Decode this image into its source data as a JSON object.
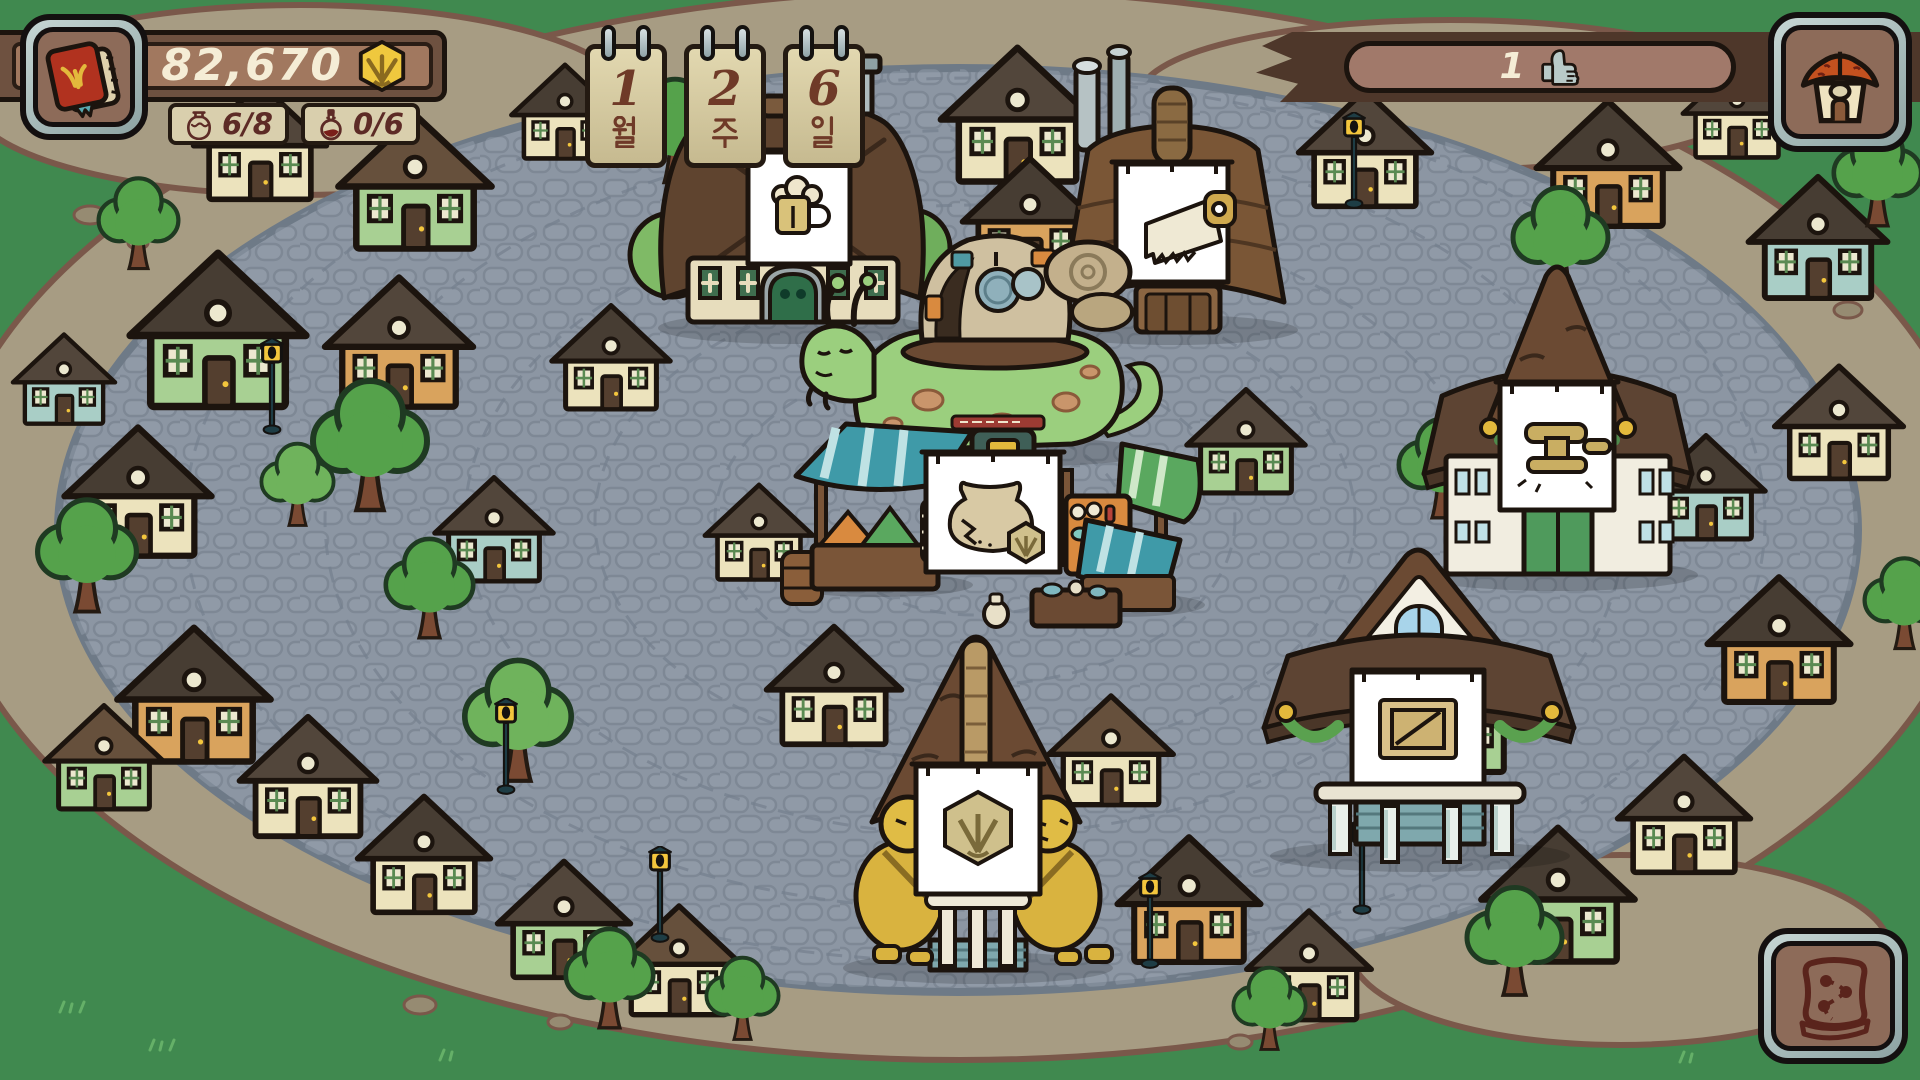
{
  "hud": {
    "journal_button": {
      "icon": "red-book-icon"
    },
    "currency": {
      "amount": "82,670",
      "icon": "hex-coin-icon"
    },
    "inventory_counters": [
      {
        "icon": "jar-icon",
        "value": "6/8"
      },
      {
        "icon": "potion-icon",
        "value": "0/6"
      }
    ],
    "calendar": {
      "cards": [
        {
          "value": "1",
          "unit": "월",
          "unit_en": "month"
        },
        {
          "value": "2",
          "unit": "주",
          "unit_en": "week"
        },
        {
          "value": "6",
          "unit": "일",
          "unit_en": "day"
        }
      ]
    },
    "reputation": {
      "value": "1",
      "icon": "thumbs-up-icon"
    },
    "home_button": {
      "icon": "house-icon"
    },
    "map_button": {
      "icon": "map-icon"
    }
  },
  "village": {
    "buildings": [
      {
        "id": "tavern",
        "sign_icon": "beer-mug-icon"
      },
      {
        "id": "sawmill",
        "sign_icon": "hand-saw-icon"
      },
      {
        "id": "town-hall",
        "sign_icon": "gavel-icon"
      },
      {
        "id": "warehouse",
        "sign_icon": "crate-icon"
      },
      {
        "id": "bank",
        "sign_icon": "hex-coin-icon"
      },
      {
        "id": "market",
        "sign_icon": "clay-pot-icon"
      }
    ],
    "npc": {
      "id": "snail-merchant"
    }
  },
  "colors": {
    "grass": "#40894f",
    "dirt": "#a79c83",
    "plaza": "#8c96a3",
    "hud_wood": "#6e5140",
    "hud_panel": "#d9cfad",
    "text_cream": "#f5edd6",
    "text_maroon": "#5d2b26",
    "coin_gold": "#efc83e",
    "banner_white": "#ffffff"
  },
  "scene": {
    "houses": [
      {
        "x": 185,
        "y": 75,
        "w": 150,
        "h": 130,
        "wall": "#ece3bd",
        "roof": "#52463b"
      },
      {
        "x": 330,
        "y": 105,
        "w": 170,
        "h": 150,
        "wall": "#a8d093",
        "roof": "#66503c"
      },
      {
        "x": 505,
        "y": 58,
        "w": 120,
        "h": 105,
        "wall": "#ece3bd",
        "roof": "#473d33"
      },
      {
        "x": 930,
        "y": 38,
        "w": 175,
        "h": 150,
        "wall": "#ece3bd",
        "roof": "#52463b"
      },
      {
        "x": 955,
        "y": 150,
        "w": 150,
        "h": 132,
        "wall": "#d9a35d",
        "roof": "#473d33"
      },
      {
        "x": 1290,
        "y": 82,
        "w": 150,
        "h": 130,
        "wall": "#ece3bd",
        "roof": "#52463b"
      },
      {
        "x": 1528,
        "y": 92,
        "w": 160,
        "h": 140,
        "wall": "#d9a35d",
        "roof": "#473d33"
      },
      {
        "x": 1676,
        "y": 56,
        "w": 122,
        "h": 106,
        "wall": "#ece3bd",
        "roof": "#52463b"
      },
      {
        "x": 1742,
        "y": 168,
        "w": 152,
        "h": 136,
        "wall": "#a9cec6",
        "roof": "#473d33"
      },
      {
        "x": 118,
        "y": 242,
        "w": 200,
        "h": 172,
        "wall": "#a8d093",
        "roof": "#473d33"
      },
      {
        "x": 318,
        "y": 268,
        "w": 162,
        "h": 145,
        "wall": "#d9a35d",
        "roof": "#52463b"
      },
      {
        "x": 58,
        "y": 418,
        "w": 160,
        "h": 144,
        "wall": "#ece3bd",
        "roof": "#473d33"
      },
      {
        "x": 8,
        "y": 328,
        "w": 112,
        "h": 100,
        "wall": "#a9cec6",
        "roof": "#52463b"
      },
      {
        "x": 545,
        "y": 298,
        "w": 132,
        "h": 116,
        "wall": "#ece3bd",
        "roof": "#473d33"
      },
      {
        "x": 428,
        "y": 470,
        "w": 132,
        "h": 116,
        "wall": "#a9cec6",
        "roof": "#52463b"
      },
      {
        "x": 698,
        "y": 478,
        "w": 122,
        "h": 106,
        "wall": "#ece3bd",
        "roof": "#52463b"
      },
      {
        "x": 108,
        "y": 618,
        "w": 172,
        "h": 150,
        "wall": "#d9a35d",
        "roof": "#473d33"
      },
      {
        "x": 38,
        "y": 698,
        "w": 132,
        "h": 116,
        "wall": "#a8d093",
        "roof": "#66503c"
      },
      {
        "x": 232,
        "y": 708,
        "w": 152,
        "h": 134,
        "wall": "#ece3bd",
        "roof": "#52463b"
      },
      {
        "x": 348,
        "y": 788,
        "w": 152,
        "h": 130,
        "wall": "#ece3bd",
        "roof": "#473d33"
      },
      {
        "x": 488,
        "y": 853,
        "w": 152,
        "h": 130,
        "wall": "#a8d093",
        "roof": "#52463b"
      },
      {
        "x": 608,
        "y": 898,
        "w": 142,
        "h": 122,
        "wall": "#ece3bd",
        "roof": "#66503c"
      },
      {
        "x": 1180,
        "y": 382,
        "w": 132,
        "h": 116,
        "wall": "#a8d093",
        "roof": "#52463b"
      },
      {
        "x": 1040,
        "y": 688,
        "w": 142,
        "h": 122,
        "wall": "#ece3bd",
        "roof": "#66503c"
      },
      {
        "x": 758,
        "y": 618,
        "w": 152,
        "h": 132,
        "wall": "#ece3bd",
        "roof": "#473d33"
      },
      {
        "x": 1108,
        "y": 828,
        "w": 162,
        "h": 140,
        "wall": "#d9a35d",
        "roof": "#473d33"
      },
      {
        "x": 1238,
        "y": 903,
        "w": 142,
        "h": 122,
        "wall": "#ece3bd",
        "roof": "#52463b"
      },
      {
        "x": 1472,
        "y": 818,
        "w": 172,
        "h": 150,
        "wall": "#a8d093",
        "roof": "#473d33"
      },
      {
        "x": 1608,
        "y": 748,
        "w": 152,
        "h": 130,
        "wall": "#ece3bd",
        "roof": "#52463b"
      },
      {
        "x": 1368,
        "y": 638,
        "w": 162,
        "h": 140,
        "wall": "#a8d093",
        "roof": "#66503c"
      },
      {
        "x": 1698,
        "y": 568,
        "w": 162,
        "h": 140,
        "wall": "#d9a35d",
        "roof": "#473d33"
      },
      {
        "x": 1768,
        "y": 358,
        "w": 142,
        "h": 126,
        "wall": "#ece3bd",
        "roof": "#52463b"
      },
      {
        "x": 1640,
        "y": 428,
        "w": 132,
        "h": 116,
        "wall": "#a9cec6",
        "roof": "#473d33"
      }
    ],
    "trees": [
      {
        "x": 295,
        "y": 372,
        "s": 150
      },
      {
        "x": 22,
        "y": 492,
        "s": 130
      },
      {
        "x": 615,
        "y": 72,
        "s": 120
      },
      {
        "x": 1135,
        "y": 152,
        "s": 115
      },
      {
        "x": 1498,
        "y": 180,
        "s": 125
      },
      {
        "x": 1820,
        "y": 120,
        "s": 115
      },
      {
        "x": 552,
        "y": 922,
        "s": 115
      },
      {
        "x": 695,
        "y": 952,
        "s": 95
      },
      {
        "x": 1452,
        "y": 880,
        "s": 125
      },
      {
        "x": 1222,
        "y": 962,
        "s": 95
      },
      {
        "x": 372,
        "y": 532,
        "s": 115
      },
      {
        "x": 448,
        "y": 652,
        "s": 140,
        "c": "#6fb35c"
      },
      {
        "x": 86,
        "y": 172,
        "s": 105
      },
      {
        "x": 1385,
        "y": 412,
        "s": 115
      },
      {
        "x": 1852,
        "y": 552,
        "s": 105
      },
      {
        "x": 250,
        "y": 438,
        "s": 95,
        "c": "#6fb35c"
      }
    ],
    "lamps": [
      {
        "x": 258,
        "y": 338
      },
      {
        "x": 1010,
        "y": 452
      },
      {
        "x": 1566,
        "y": 436
      },
      {
        "x": 1136,
        "y": 872
      },
      {
        "x": 1348,
        "y": 818
      },
      {
        "x": 646,
        "y": 846
      },
      {
        "x": 1340,
        "y": 112
      },
      {
        "x": 492,
        "y": 698
      }
    ]
  }
}
